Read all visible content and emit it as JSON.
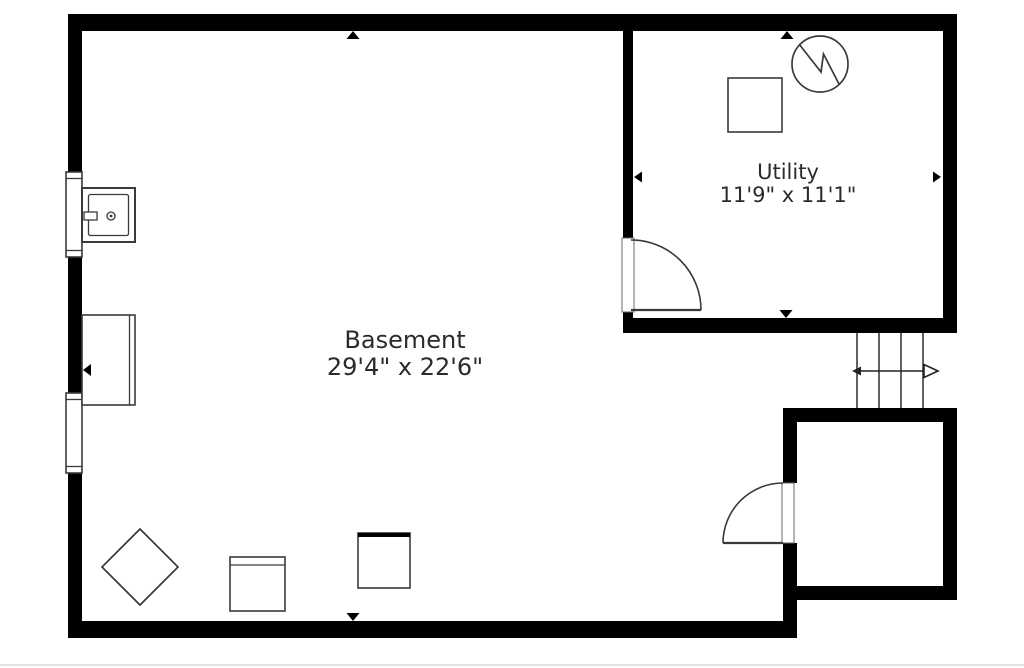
{
  "rooms": [
    {
      "name": "Basement",
      "dimensions": "29'4\" x 22'6\""
    },
    {
      "name": "Utility",
      "dimensions": "11'9\" x 11'1\""
    }
  ],
  "fixtures": [
    {
      "name": "laundry-sink",
      "location": "basement upper-left, at window"
    },
    {
      "name": "shelf-unit",
      "location": "basement left wall"
    },
    {
      "name": "water-heater",
      "location": "utility room, circle with zigzag"
    },
    {
      "name": "furnace-box",
      "location": "utility room, square"
    },
    {
      "name": "diamond-table",
      "location": "basement bottom-left, rotated square"
    },
    {
      "name": "appliance-box",
      "location": "basement bottom, square with top line"
    },
    {
      "name": "appliance-box-thick-top",
      "location": "basement bottom, square with thick top edge"
    },
    {
      "name": "stairs-up",
      "location": "right side, four treads with direction arrow"
    },
    {
      "name": "utility-door",
      "location": "utility room lower-left, swings in"
    },
    {
      "name": "storage-door",
      "location": "bottom-right room, swings out left"
    },
    {
      "name": "window",
      "count": 2,
      "location": "left exterior wall"
    }
  ],
  "colors": {
    "wall": "#000000",
    "fixture_line": "#3a3a3a",
    "text": "#2b2b2b",
    "background": "#ffffff",
    "page_edge": "#d9d9d9"
  }
}
